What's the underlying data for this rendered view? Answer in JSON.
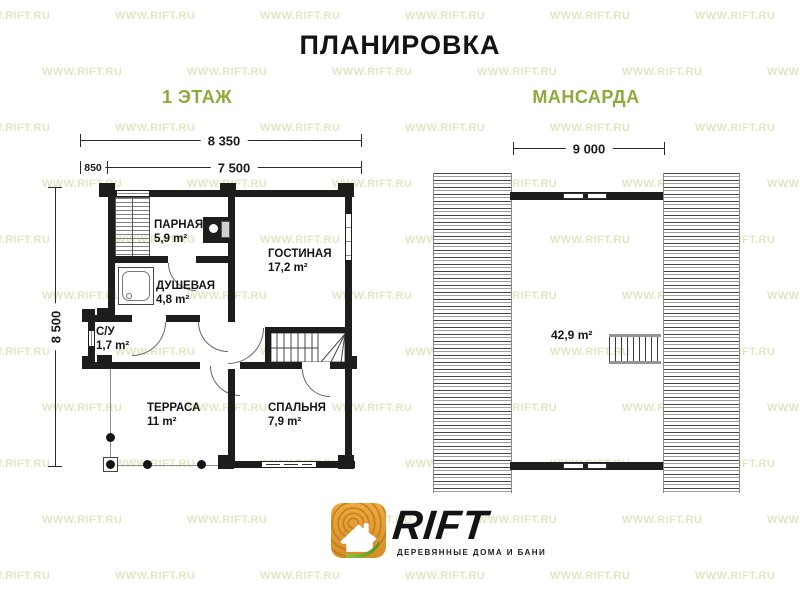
{
  "title": "ПЛАНИРОВКА",
  "watermark": "WWW.RIFT.RU",
  "floor1": {
    "label": "1 ЭТАЖ",
    "dim_total": "8 350",
    "dim_terrace": "850",
    "dim_main": "7 500",
    "dim_side": "8 500",
    "rooms": {
      "parnaya": {
        "name": "ПАРНАЯ",
        "area": "5,9 m²"
      },
      "dushevaya": {
        "name": "ДУШЕВАЯ",
        "area": "4,8 m²"
      },
      "gostinaya": {
        "name": "ГОСТИНАЯ",
        "area": "17,2 m²"
      },
      "su": {
        "name": "С/У",
        "area": "1,7 m²"
      },
      "terrasa": {
        "name": "ТЕРРАСА",
        "area": "11 m²"
      },
      "spalnya": {
        "name": "СПАЛЬНЯ",
        "area": "7,9 m²"
      }
    }
  },
  "attic": {
    "label": "МАНСАРДА",
    "dim_width": "9 000",
    "area": "42,9 m²"
  },
  "logo": {
    "brand": "RIFT",
    "tagline": "ДЕРЕВЯННЫЕ ДОМА И БАНИ"
  },
  "colors": {
    "accent_green": "#8cab3a",
    "watermark": "#e3e5c6",
    "wall_black": "#1d1d1b",
    "logo_orange": "#e29b33",
    "leaf_green": "#6fae2f"
  }
}
